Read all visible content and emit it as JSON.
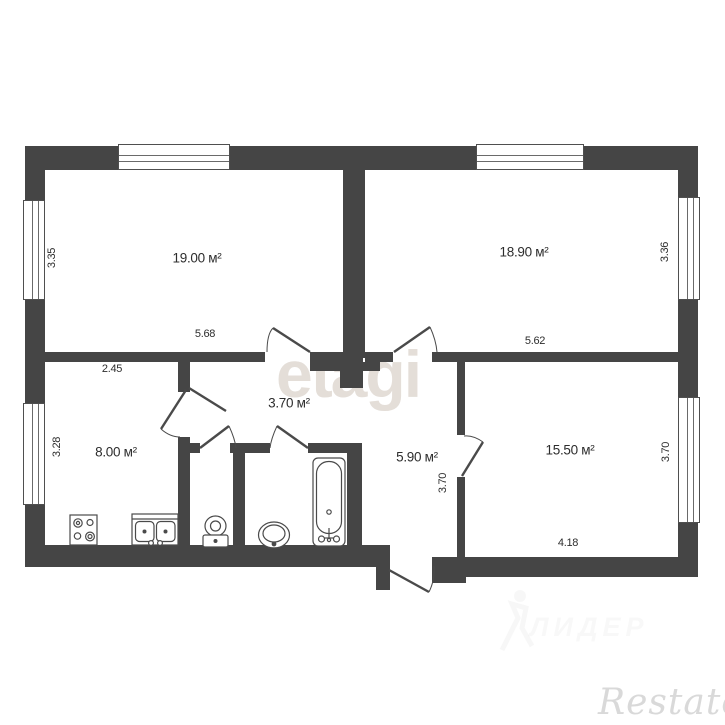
{
  "rooms": [
    {
      "name": "room-19",
      "area": "19.00 м²",
      "width": "5.68",
      "side": "3.35"
    },
    {
      "name": "room-18-9",
      "area": "18.90 м²",
      "width": "5.62",
      "side": "3.36"
    },
    {
      "name": "kitchen",
      "area": "8.00 м²",
      "width": "2.45",
      "side": "3.28"
    },
    {
      "name": "hallway-inner",
      "area": "3.70 м²"
    },
    {
      "name": "hallway-entry",
      "area": "5.90 м²",
      "side": "3.70"
    },
    {
      "name": "room-15-5",
      "area": "15.50 м²",
      "width": "4.18",
      "side": "3.70"
    }
  ],
  "watermarks": {
    "center": "etagi",
    "agency": "Restate",
    "faint": "ЛИДЕР"
  },
  "colors": {
    "wall": "#454545",
    "fixture_line": "#4a4a4a",
    "dimension_text": "#2d2d2d",
    "watermark_center": "#e4ded8",
    "watermark_agency": "#d9d9d9"
  }
}
